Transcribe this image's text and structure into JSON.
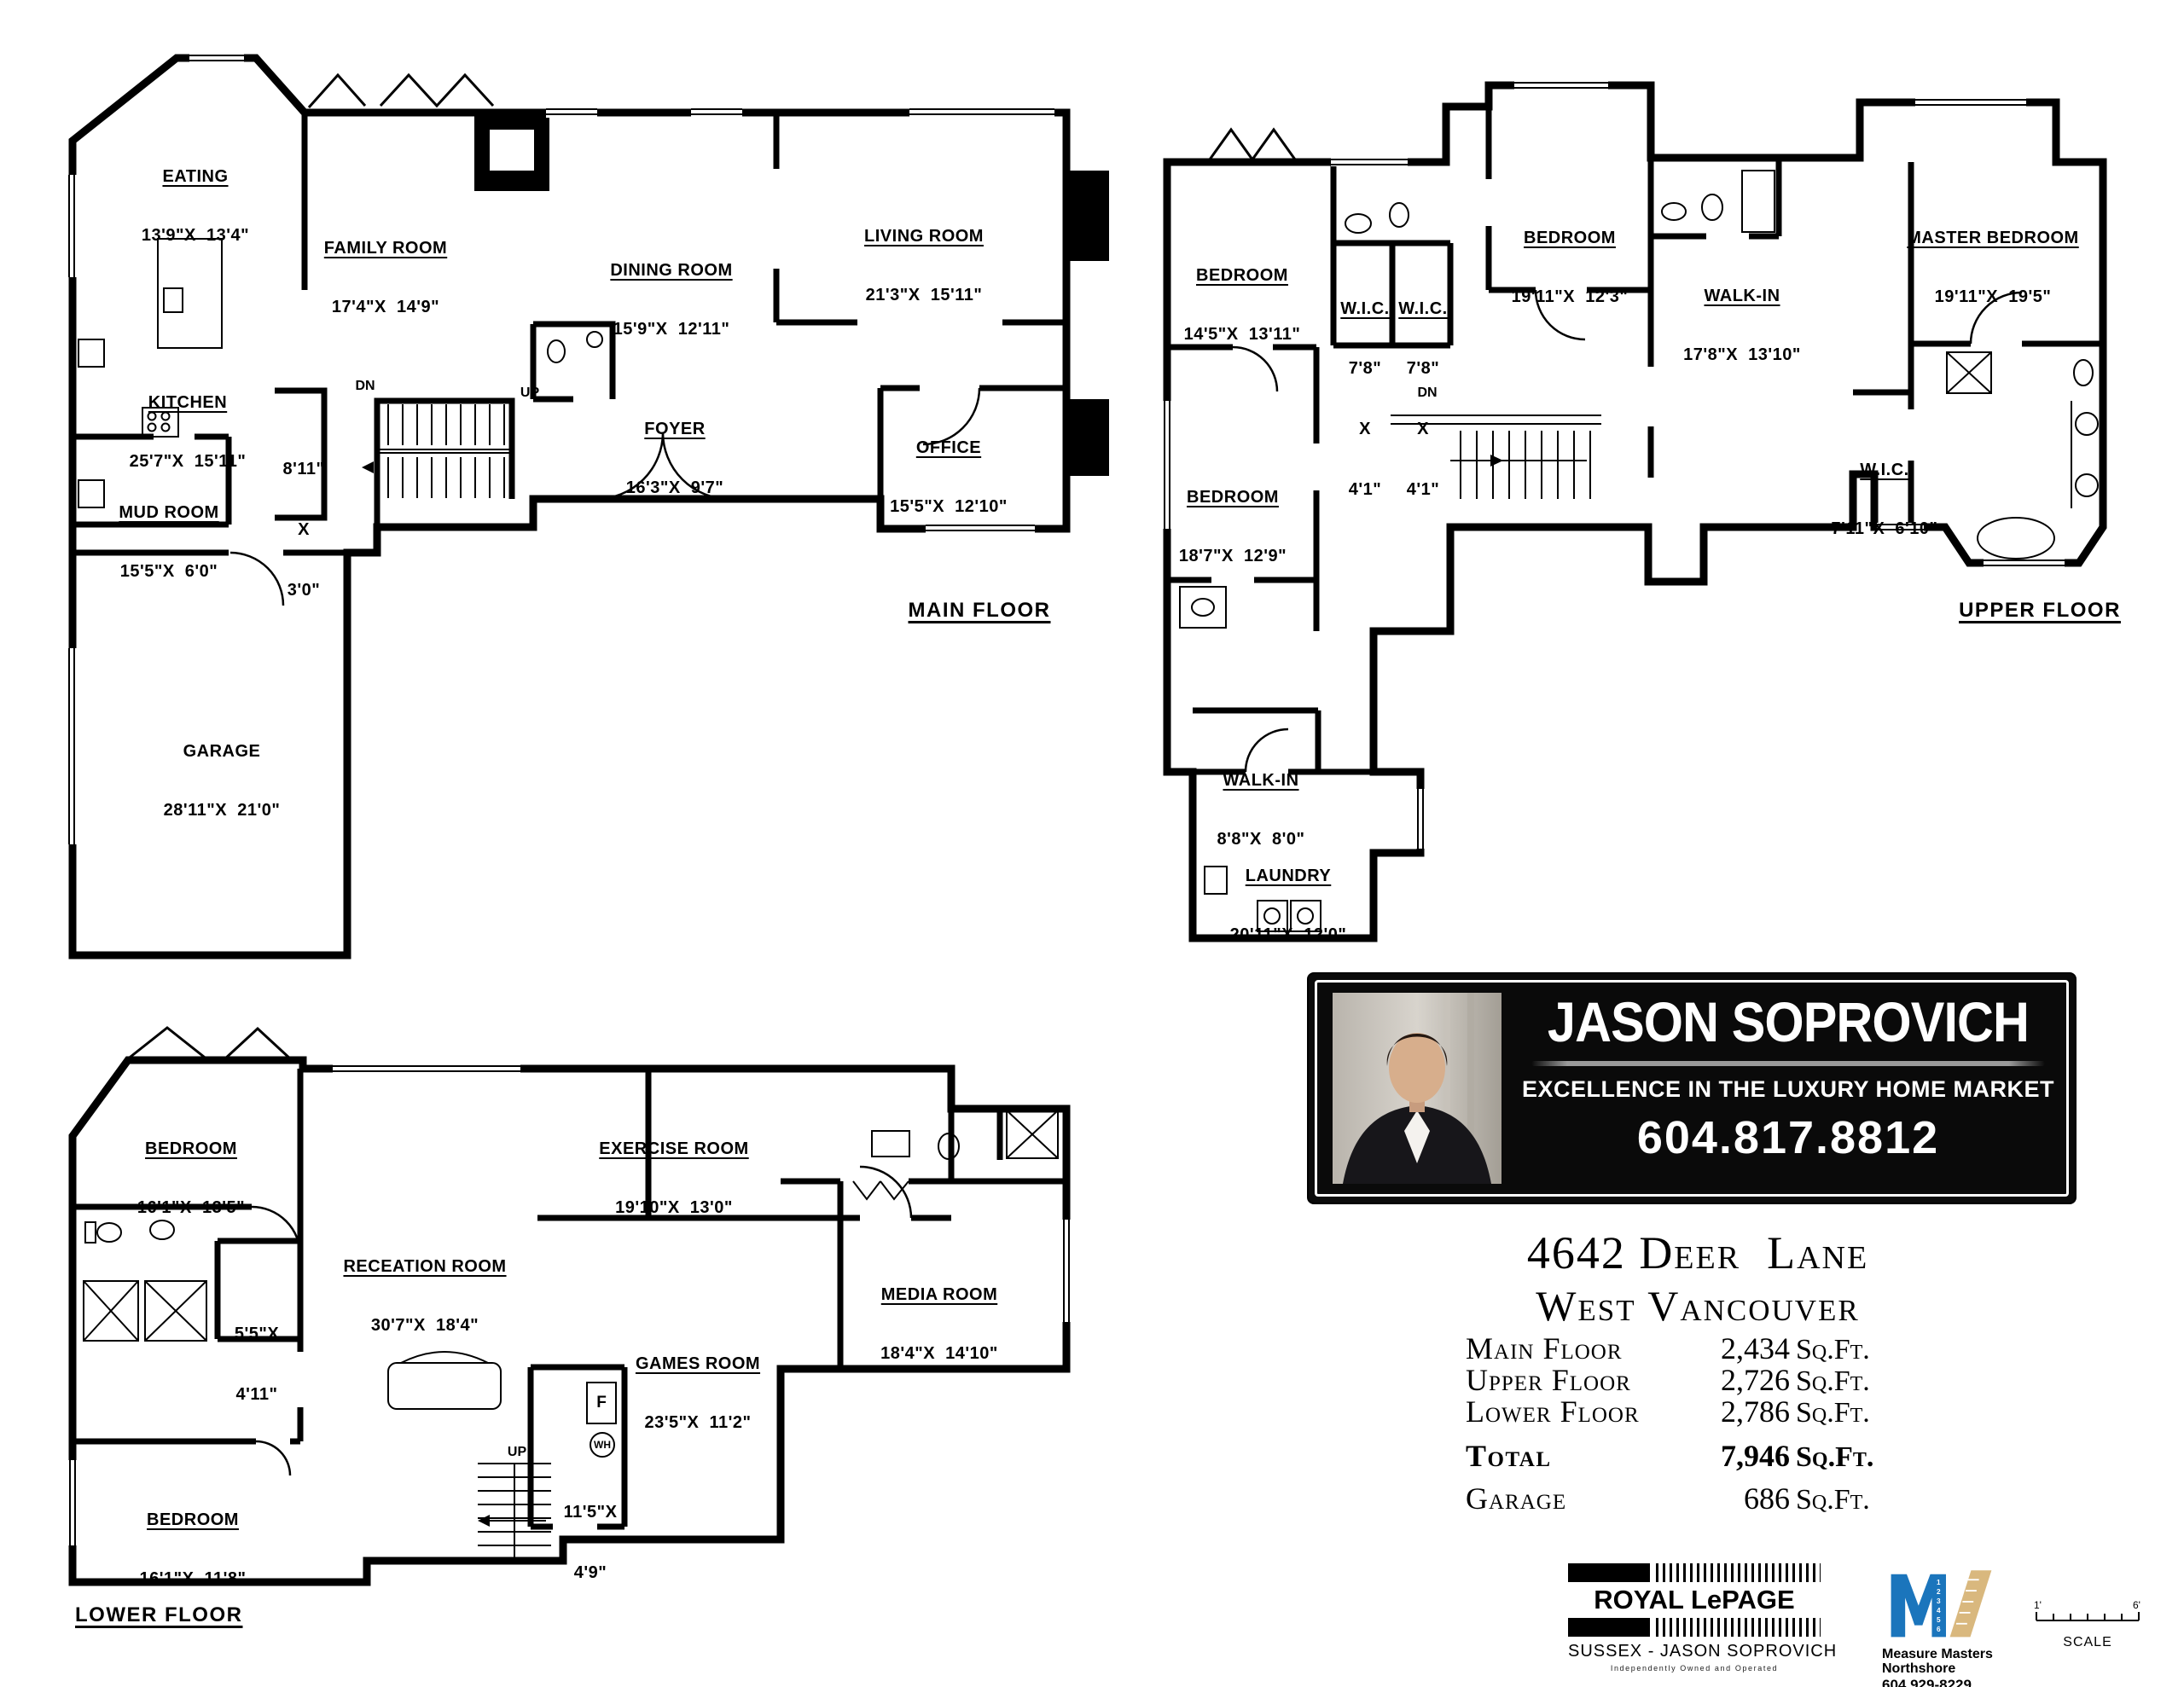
{
  "floors": [
    {
      "title": "MAIN FLOOR",
      "rooms": [
        {
          "name": "EATING",
          "dims": "13'9\"X  13'4\""
        },
        {
          "name": "FAMILY ROOM",
          "dims": "17'4\"X  14'9\""
        },
        {
          "name": "DINING ROOM",
          "dims": "15'9\"X  12'11\""
        },
        {
          "name": "LIVING ROOM",
          "dims": "21'3\"X  15'11\""
        },
        {
          "name": "KITCHEN",
          "dims": "25'7\"X  15'11\""
        },
        {
          "name": "FOYER",
          "dims": "16'3\"X  9'7\""
        },
        {
          "name": "OFFICE",
          "dims": "15'5\"X  12'10\""
        },
        {
          "name": "MUD ROOM",
          "dims": "15'5\"X  6'0\""
        },
        {
          "name": "GARAGE",
          "dims": "28'11\"X  21'0\""
        },
        {
          "lines": [
            "8'11\"",
            "X",
            "3'0\""
          ]
        }
      ],
      "notes": {
        "dn": "DN",
        "up": "UP"
      }
    },
    {
      "title": "UPPER FLOOR",
      "rooms": [
        {
          "name": "BEDROOM",
          "dims": "14'5\"X  13'11\""
        },
        {
          "name": "BEDROOM",
          "dims": "19'11\"X  12'3\""
        },
        {
          "name": "MASTER BEDROOM",
          "dims": "19'11\"X  19'5\""
        },
        {
          "name": "WALK-IN",
          "dims": "17'8\"X  13'10\""
        },
        {
          "name": "BEDROOM",
          "dims": "18'7\"X  12'9\""
        },
        {
          "name": "W.I.C.",
          "dims": "7'11\"X  6'10\""
        },
        {
          "name": "WALK-IN",
          "dims": "8'8\"X  8'0\""
        },
        {
          "name": "LAUNDRY",
          "dims": "20'11\"X  12'0\""
        },
        {
          "name": "W.I.C.",
          "lines": [
            "7'8\"",
            "X",
            "4'1\""
          ]
        },
        {
          "name": "W.I.C.",
          "lines": [
            "7'8\"",
            "X",
            "4'1\""
          ]
        }
      ],
      "notes": {
        "dn": "DN"
      }
    },
    {
      "title": "LOWER FLOOR",
      "rooms": [
        {
          "name": "BEDROOM",
          "dims": "16'1\"X  13'5\""
        },
        {
          "name": "RECEATION ROOM",
          "dims": "30'7\"X  18'4\""
        },
        {
          "name": "EXERCISE ROOM",
          "dims": "19'10\"X  13'0\""
        },
        {
          "name": "GAMES ROOM",
          "dims": "23'5\"X  11'2\""
        },
        {
          "name": "MEDIA ROOM",
          "dims": "18'4\"X  14'10\""
        },
        {
          "name": "BEDROOM",
          "dims": "16'1\"X  11'8\""
        },
        {
          "lines": [
            "5'5\"X",
            "4'11\""
          ]
        },
        {
          "lines": [
            "11'5\"X",
            "4'9\""
          ]
        }
      ],
      "notes": {
        "up": "UP",
        "furnace": "F",
        "water_heater": "WH"
      }
    }
  ],
  "banner": {
    "agent_name": "JASON SOPROVICH",
    "tagline": "EXCELLENCE IN THE LUXURY HOME MARKET",
    "phone": "604.817.8812"
  },
  "listing": {
    "address_line1": "4642 Deer  Lane",
    "address_line2": "West Vancouver",
    "areas": [
      {
        "label": "Main Floor",
        "value": "2,434",
        "unit": "Sq.Ft."
      },
      {
        "label": "Upper Floor",
        "value": "2,726",
        "unit": "Sq.Ft."
      },
      {
        "label": "Lower Floor",
        "value": "2,786",
        "unit": "Sq.Ft."
      },
      {
        "label": "Total",
        "value": "7,946",
        "unit": "Sq.Ft."
      },
      {
        "label": "Garage",
        "value": "686",
        "unit": "Sq.Ft."
      }
    ]
  },
  "logos": {
    "royal_lepage": {
      "brand": "ROYAL LePAGE",
      "sub": "SUSSEX - JASON SOPROVICH",
      "tagline": "Independently Owned and Operated"
    },
    "measure_masters": {
      "name": "Measure Masters Northshore",
      "phone": "604 929-8229",
      "m_color": "#1b75bc",
      "ruler_color": "#d9b87e"
    },
    "scale_bar": {
      "left": "1'",
      "right": "6'",
      "label": "SCALE"
    }
  }
}
